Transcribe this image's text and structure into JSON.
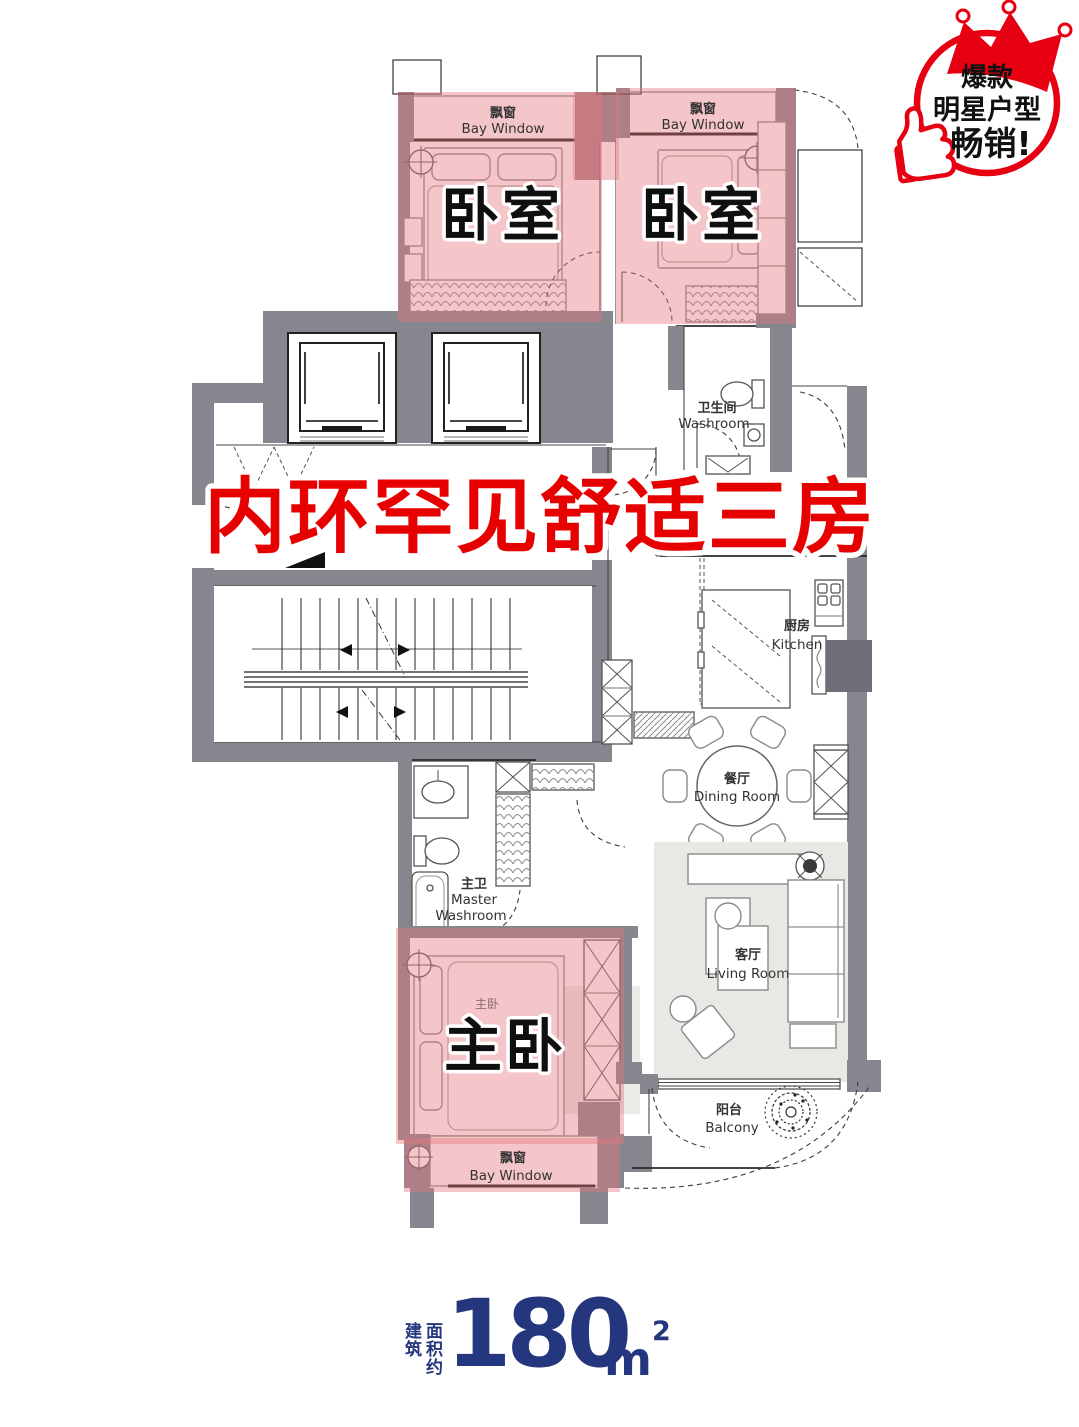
{
  "badge": {
    "line1": "爆款",
    "line2": "明星户型",
    "line3": "畅销!"
  },
  "headline": "内环罕见舒适三房",
  "rooms": {
    "bedroom_left": {
      "name": "卧室"
    },
    "bedroom_right": {
      "name": "卧室"
    },
    "master_bedroom": {
      "name": "主卧",
      "plan_label_cn": "主卧"
    },
    "bay_window_top_left": {
      "cn": "飘窗",
      "en": "Bay Window"
    },
    "bay_window_top_right": {
      "cn": "飘窗",
      "en": "Bay Window"
    },
    "bay_window_bottom": {
      "cn": "飘窗",
      "en": "Bay Window"
    },
    "washroom": {
      "cn": "卫生间",
      "en": "Washroom"
    },
    "kitchen": {
      "cn": "厨房",
      "en": "Kitchen"
    },
    "dining_room": {
      "cn": "餐厅",
      "en": "Dining Room"
    },
    "living_room": {
      "cn": "客厅",
      "en": "Living Room"
    },
    "master_washroom": {
      "cn": "主卫",
      "en_line1": "Master",
      "en_line2": "Washroom"
    },
    "balcony": {
      "cn": "阳台",
      "en": "Balcony"
    }
  },
  "area": {
    "label_col1": "建筑",
    "label_col2": "面积约",
    "value": "180",
    "unit": "m",
    "exponent": "2"
  },
  "colors": {
    "accent-red": "#e60000",
    "badge-red": "#e60012",
    "wall-gray": "#86868e",
    "highlight-pink": "rgba(231,118,127,0.42)",
    "area-navy": "#24367e"
  }
}
